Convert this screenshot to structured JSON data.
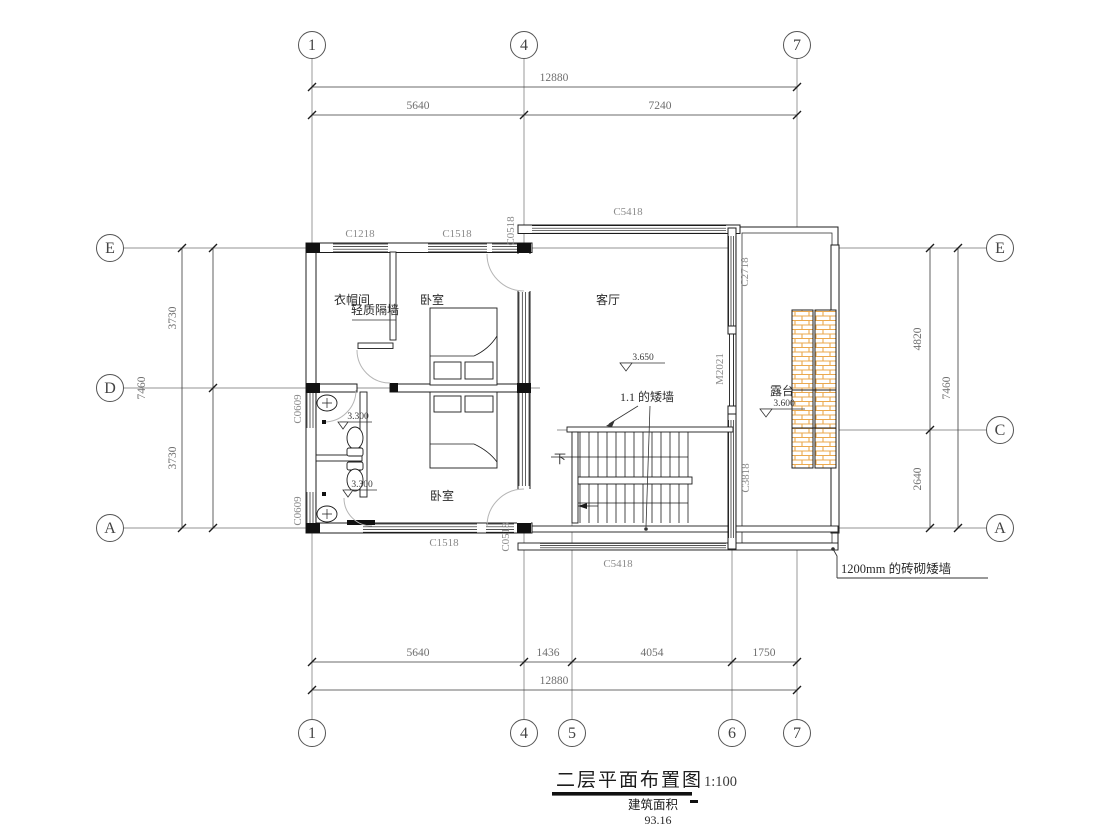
{
  "drawing": {
    "title": "二层平面布置图",
    "scale": "1:100",
    "area_label": "建筑面积",
    "area_value": "93.16"
  },
  "grid": {
    "cols": [
      "1",
      "4",
      "5",
      "6",
      "7"
    ],
    "left_rows": [
      "E",
      "D",
      "A"
    ],
    "right_rows": [
      "E",
      "C",
      "A"
    ]
  },
  "dims": {
    "top_total": "12880",
    "top_segments": [
      "5640",
      "7240"
    ],
    "bottom_segments": [
      "5640",
      "1436",
      "4054",
      "1750"
    ],
    "bottom_total": "12880",
    "left_segments": [
      "3730",
      "3730"
    ],
    "left_total": "7460",
    "right_segments": [
      "4820",
      "2640"
    ],
    "right_total": "7460"
  },
  "rooms": {
    "living_room": "客厅",
    "bedroom_top": "卧室",
    "bedroom_bottom": "卧室",
    "closet": "衣帽间",
    "terrace": "露台"
  },
  "openings": {
    "c1218": "C1218",
    "c1518_top": "C1518",
    "c0518_top": "C0518",
    "c5418_top": "C5418",
    "c2718": "C2718",
    "m2021": "M2021",
    "c3818": "C3818",
    "c5418_bottom": "C5418",
    "c1518_bottom": "C1518",
    "c0518_bottom": "C0518",
    "c0609_upper": "C0609",
    "c0609_lower": "C0609"
  },
  "annotations": {
    "partition": "轻质隔墙",
    "low_wall": "1.1 的矮墙",
    "brick_low_wall": "1200mm 的砖砌矮墙",
    "stair_down": "下"
  },
  "elevations": {
    "living": "3.650",
    "terrace": "3.600",
    "bath_upper": "3.300",
    "bath_lower": "3.300"
  },
  "colors": {
    "line": "#1c1c1c",
    "dim_text": "#6e6e6e",
    "label_text": "#8a8a8a",
    "room_text": "#2a2a2a",
    "brick_hatch": "#EBA94E",
    "door_arc": "#b5b5b5"
  }
}
